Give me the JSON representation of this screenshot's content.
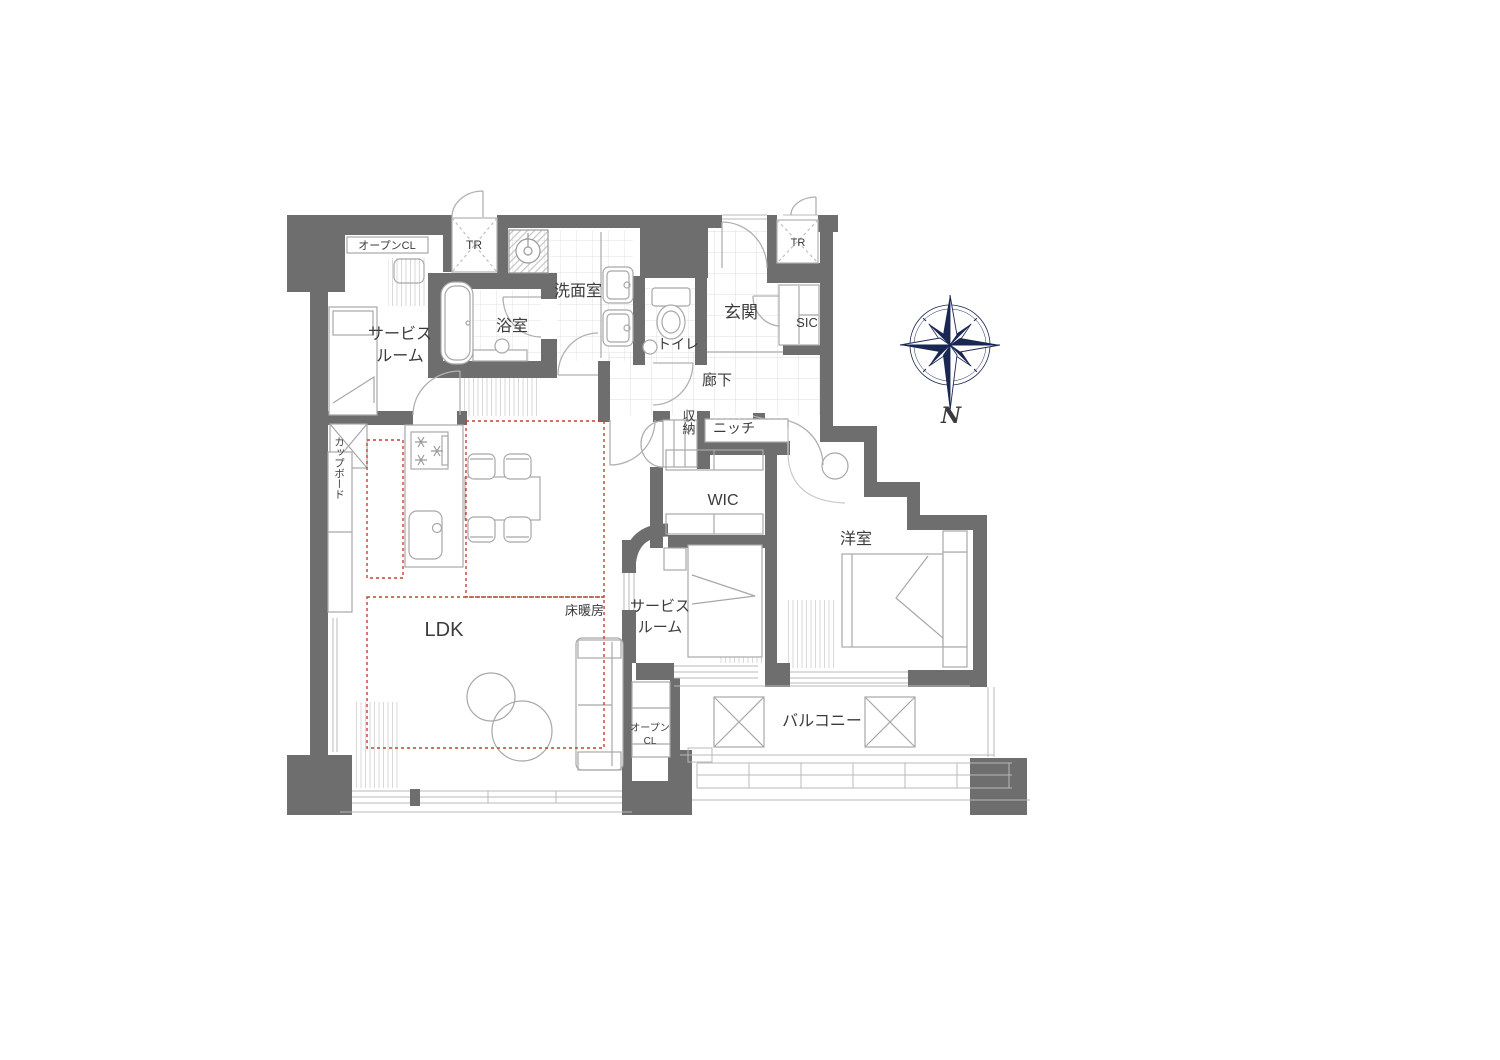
{
  "floor_plan": {
    "rooms": {
      "service_room_1": {
        "line1": "サービス",
        "line2": "ルーム"
      },
      "bathroom": {
        "label": "浴室"
      },
      "washroom": {
        "label": "洗面室"
      },
      "toilet": {
        "label": "トイレ"
      },
      "entrance": {
        "label": "玄関"
      },
      "shoe_closet": {
        "label": "SIC"
      },
      "hallway": {
        "label": "廊下"
      },
      "niche": {
        "label": "ニッチ"
      },
      "storage": {
        "label": "収納"
      },
      "walk_in_closet": {
        "label": "WIC"
      },
      "western_room": {
        "label": "洋室"
      },
      "service_room_2": {
        "line1": "サービス",
        "line2": "ルーム"
      },
      "ldk": {
        "label": "LDK"
      },
      "balcony": {
        "label": "バルコニー"
      }
    },
    "fixtures": {
      "cupboard": {
        "label": "カップボード"
      },
      "open_closet_1": {
        "label": "オープンCL"
      },
      "open_closet_2": {
        "line1": "オープン",
        "line2": "CL"
      },
      "trunk_room_1": {
        "label": "TR"
      },
      "trunk_room_2": {
        "label": "TR"
      }
    },
    "annotations": {
      "floor_heating": {
        "label": "床暖房",
        "color": "#c2452e"
      }
    },
    "compass": {
      "north_label": "N",
      "color": "#1a2750"
    },
    "colors": {
      "wall": "#6e6e6e",
      "line": "#a9a9a9",
      "tile_line": "#dddddd",
      "text": "#3b3b3b",
      "heating_dash": "#c2452e"
    }
  }
}
